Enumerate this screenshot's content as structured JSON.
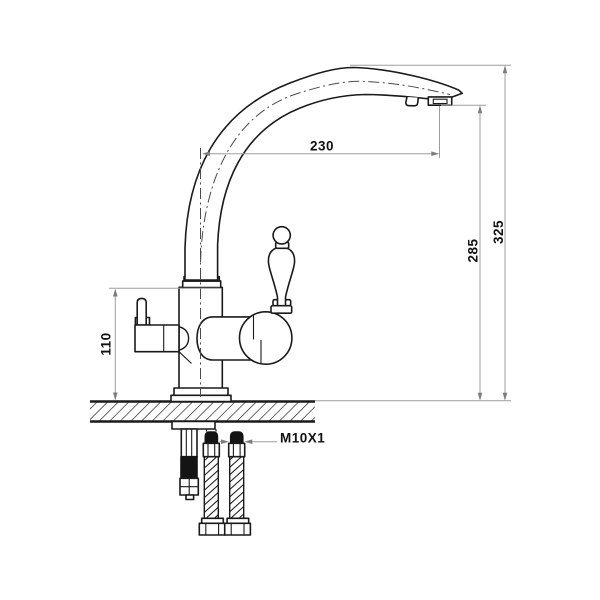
{
  "drawing": {
    "subject": "kitchen-faucet-technical-drawing-side-view",
    "dimensions": {
      "spout_reach": {
        "label": "230",
        "orientation": "horizontal",
        "measures": "spout projection from body centerline to outlet"
      },
      "outlet_height": {
        "label": "285",
        "orientation": "vertical",
        "measures": "height from countertop to spout outlet"
      },
      "overall_height": {
        "label": "325",
        "orientation": "vertical",
        "measures": "height from countertop to top of spout"
      },
      "body_height": {
        "label": "110",
        "orientation": "vertical",
        "measures": "height from countertop to top of body"
      },
      "hose_thread": {
        "label": "M10X1",
        "orientation": "leader",
        "measures": "supply hose connector thread"
      }
    },
    "colors": {
      "outline": "#1a1a1a",
      "dimension_line": "#9d9d9d",
      "arrowhead": "#7d7d7d",
      "label_text": "#111111",
      "background": "#ffffff",
      "hose_tip_fill": "#141414"
    }
  }
}
